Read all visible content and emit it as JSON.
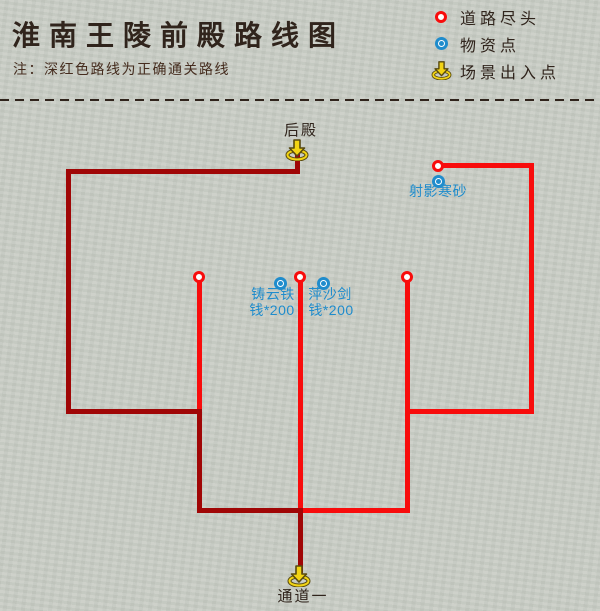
{
  "header": {
    "title": "淮南王陵前殿路线图",
    "note": "注：深红色路线为正确通关路线"
  },
  "legend": {
    "items": [
      {
        "icon": "road-end-icon",
        "label": "道路尽头"
      },
      {
        "icon": "supply-point-icon",
        "label": "物资点"
      },
      {
        "icon": "portal-icon",
        "label": "场景出入点"
      }
    ]
  },
  "colors": {
    "background": "#c9cdc5",
    "ink": "#30241c",
    "note_ink": "#452c1e",
    "route_correct": "#a00606",
    "route_branch": "#f80c0c",
    "supply_blue": "#1f8ccc",
    "portal_fill": "#f2d414",
    "portal_outline": "#57490f"
  },
  "map": {
    "portals": [
      {
        "id": "houdian",
        "label": "后殿",
        "x": 297,
        "y": 150,
        "label_x": 301,
        "label_y": 119
      },
      {
        "id": "tongdao-yi",
        "label": "通道一",
        "x": 299,
        "y": 576,
        "label_x": 303,
        "label_y": 585
      }
    ],
    "road_ends": [
      {
        "x": 199,
        "y": 277
      },
      {
        "x": 300,
        "y": 277
      },
      {
        "x": 407,
        "y": 277
      },
      {
        "x": 438,
        "y": 166
      }
    ],
    "supply_points": [
      {
        "x": 280,
        "y": 283
      },
      {
        "x": 323,
        "y": 283
      },
      {
        "x": 438,
        "y": 181
      }
    ],
    "supply_labels": [
      {
        "text": "铸云铁",
        "x": 273,
        "y": 294
      },
      {
        "text": "钱*200",
        "x": 272,
        "y": 310
      },
      {
        "text": "萍沙剑",
        "x": 330,
        "y": 294
      },
      {
        "text": "钱*200",
        "x": 331,
        "y": 310
      },
      {
        "text": "射影寒砂",
        "x": 438,
        "y": 191
      }
    ],
    "segments": {
      "correct": [
        [
          297,
          153,
          297,
          171
        ],
        [
          68,
          171,
          297,
          171
        ],
        [
          68,
          171,
          68,
          411
        ],
        [
          68,
          411,
          199,
          411
        ],
        [
          199,
          411,
          199,
          510
        ],
        [
          199,
          510,
          300,
          510
        ],
        [
          300,
          510,
          300,
          570
        ]
      ],
      "branch": [
        [
          199,
          277,
          199,
          411
        ],
        [
          300,
          277,
          300,
          510
        ],
        [
          300,
          510,
          407,
          510
        ],
        [
          407,
          277,
          407,
          510
        ],
        [
          407,
          411,
          531,
          411
        ],
        [
          531,
          165,
          531,
          411
        ],
        [
          437,
          165,
          531,
          165
        ]
      ]
    }
  }
}
